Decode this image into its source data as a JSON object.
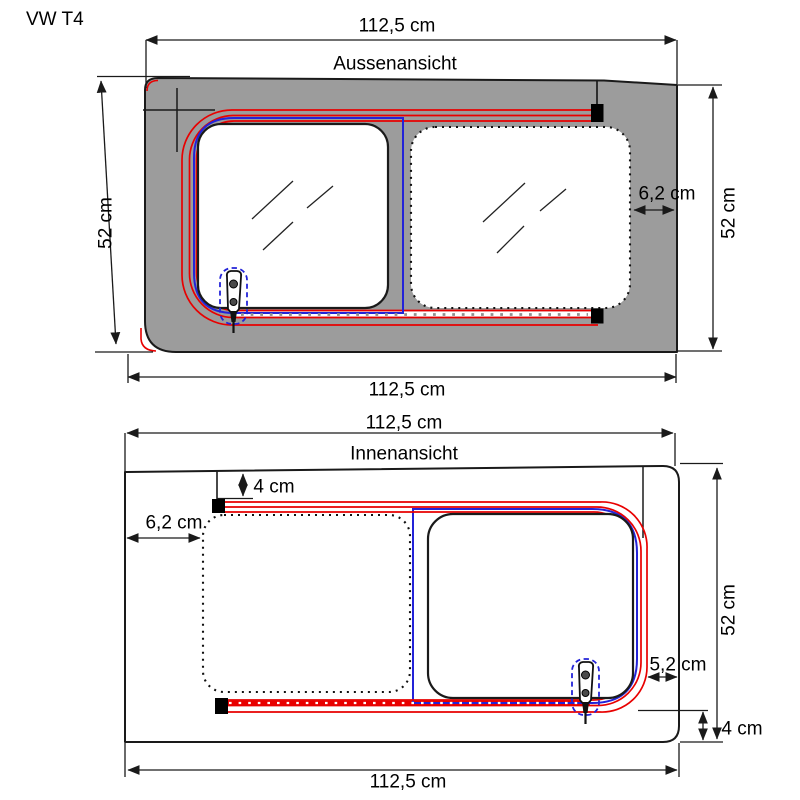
{
  "title": "VW T4",
  "colors": {
    "body_gray": "#9c9c9c",
    "seal_red": "#e80000",
    "seal_blue": "#2323d8",
    "line_black": "#1a1a1a"
  },
  "views": {
    "outside": {
      "label": "Aussenansicht",
      "dim_top": "112,5 cm",
      "dim_bottom": "112,5 cm",
      "dim_left": "52 cm",
      "dim_right": "52 cm",
      "frame_offset_right": "6,2 cm"
    },
    "inside": {
      "label": "Innenansicht",
      "dim_top": "112,5 cm",
      "dim_bottom": "112,5 cm",
      "dim_right": "52 cm",
      "offset_top": "4 cm",
      "offset_left": "6,2 cm",
      "offset_slider_right": "5,2 cm",
      "offset_bottom": "4 cm"
    }
  }
}
